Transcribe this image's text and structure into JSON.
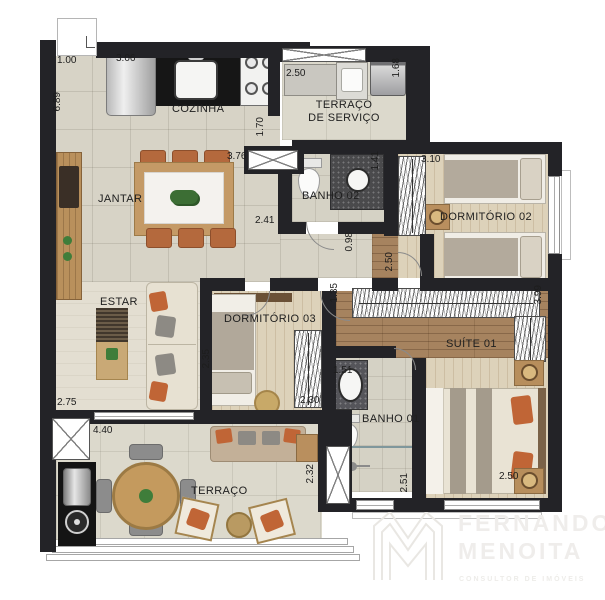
{
  "title": "apartment-floor-plan",
  "rooms": {
    "cozinha": "COZINHA",
    "terraco_servico_l1": "TERRAÇO",
    "terraco_servico_l2": "DE SERVIÇO",
    "jantar": "JANTAR",
    "banho02": "BANHO 02",
    "dormitorio02": "DORMITÓRIO 02",
    "estar": "ESTAR",
    "dormitorio03": "DORMITÓRIO 03",
    "suite01": "SUÍTE 01",
    "banho01": "BANHO 01",
    "terraco": "TERRAÇO"
  },
  "dims": [
    "1.00",
    "3.06",
    "6.89",
    "2.50",
    "1.68",
    "1.70",
    "3.76",
    "2.41",
    "1.41",
    "3.10",
    "0.98",
    "2.50",
    "1.35",
    "3.99",
    "2.35",
    "2.30",
    "1.51",
    "2.75",
    "4.40",
    "2.32",
    "2.51",
    "2.50"
  ],
  "watermark": {
    "line1": "FERNANDO",
    "line2": "MENOITA",
    "tagline": "CONSULTOR DE IMÓVEIS"
  },
  "colors": {
    "wall": "#232327",
    "tile_floor": "#d7d3c6",
    "terrace_floor": "#dcd9cc",
    "wood_light": "#ddd2ba",
    "wood_corridor": "#a6835f",
    "estar_floor": "#e3ded1",
    "terracotta_accent": "#b4693d",
    "gray_textile": "#a9a195",
    "sofa_cream": "#e7e1d2",
    "granite": "#4a4a4c",
    "marble": "#f4f2ee"
  }
}
